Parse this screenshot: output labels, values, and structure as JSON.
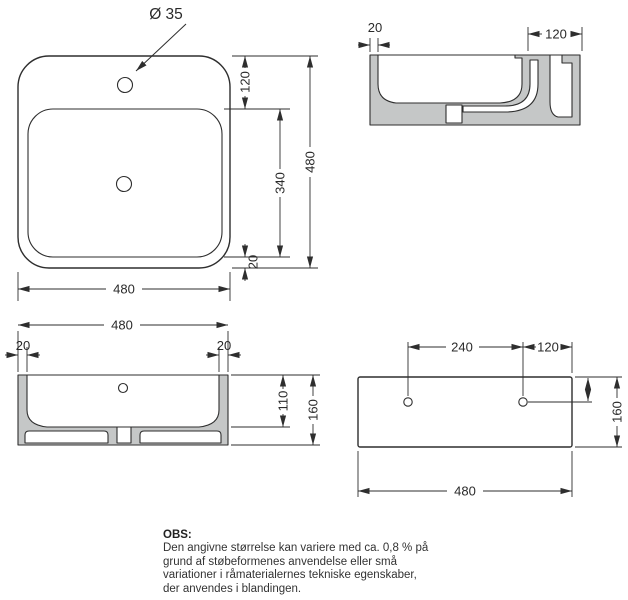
{
  "colors": {
    "line": "#2e2e2e",
    "section_fill": "#c5c7c7",
    "text": "#2a2a2a",
    "background": "#ffffff"
  },
  "top_view": {
    "faucet_hole_label": "Ø 35",
    "dim_hole_inset": "120",
    "dim_basin_length": "340",
    "dim_overall_depth": "480",
    "dim_rim": "20",
    "dim_overall_width": "480"
  },
  "side_section": {
    "dim_wall_thickness": "20",
    "dim_overflow_width": "120"
  },
  "front_section": {
    "dim_overall_width": "480",
    "dim_wall_left": "20",
    "dim_wall_right": "20",
    "dim_basin_depth": "110",
    "dim_overall_height": "160"
  },
  "rear_view": {
    "dim_hole_spacing": "240",
    "dim_hole_to_edge": "120",
    "dim_height": "160",
    "dim_width": "480"
  },
  "note": {
    "heading": "OBS",
    "separator": ":",
    "lines": [
      "Den angivne størrelse kan variere med ca. 0,8 % på",
      "grund af støbeformenes anvendelse eller små",
      "variationer i råmaterialernes tekniske egenskaber,",
      "der anvendes i blandingen."
    ]
  }
}
